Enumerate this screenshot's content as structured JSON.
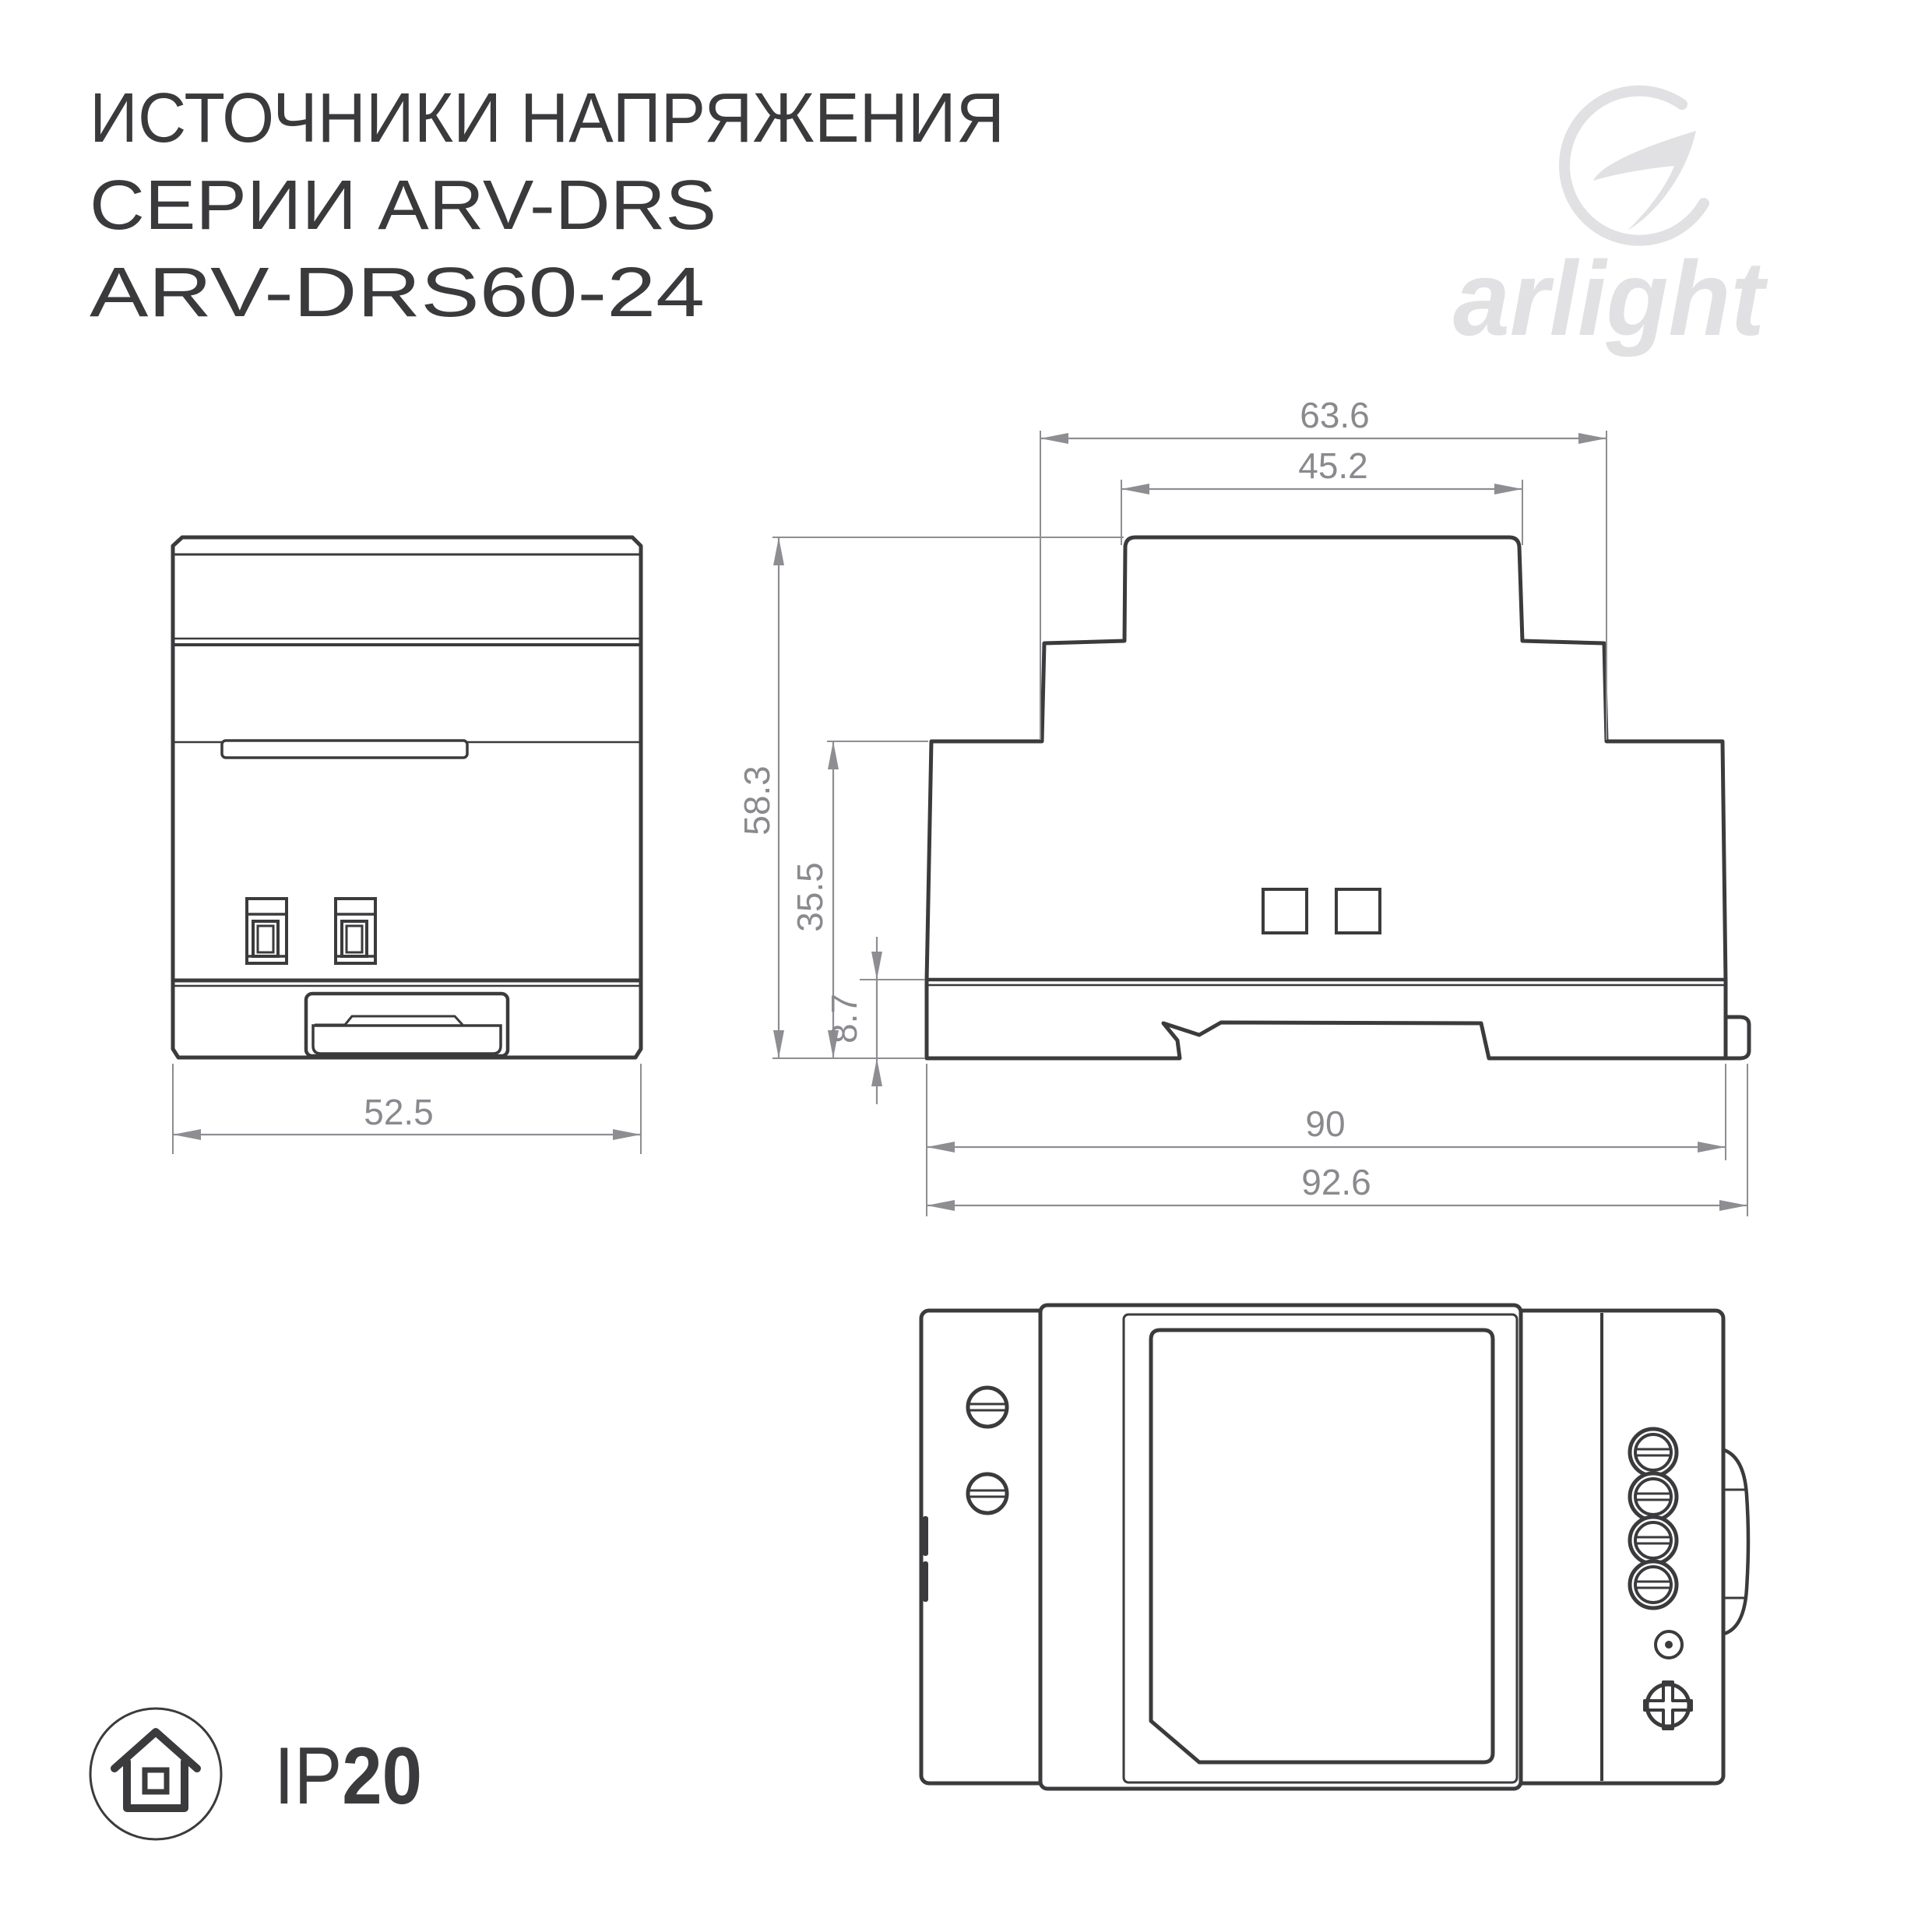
{
  "title": {
    "line1": "ИСТОЧНИКИ НАПРЯЖЕНИЯ",
    "line2": "СЕРИИ ARV-DRS",
    "line3": "ARV-DRS60-24"
  },
  "logo": {
    "text": "arlight"
  },
  "ip_rating": {
    "prefix": "IP",
    "value": "20"
  },
  "views": {
    "front": {
      "dim_width": "52.5"
    },
    "side": {
      "dim_top_width": "63.6",
      "dim_hat_width": "45.2",
      "dim_total_height": "58.3",
      "dim_body_height": "35.5",
      "dim_rail_height": "8.7",
      "dim_body_width": "90",
      "dim_full_width": "92.6"
    }
  },
  "colors": {
    "background": "#ffffff",
    "outline": "#3b3b3d",
    "dimension": "#8e8e92",
    "title_text": "#3a3a3c",
    "logo_gray": "#e1e1e3"
  }
}
